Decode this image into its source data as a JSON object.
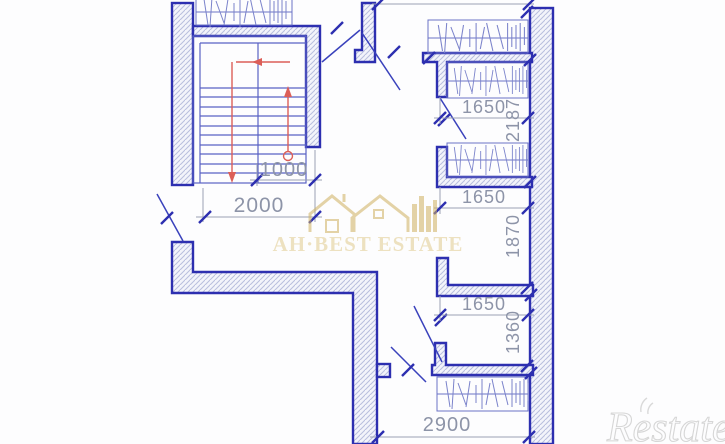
{
  "drawing": {
    "dimensions": {
      "top_room_width": "1650",
      "top_room_height": "2187",
      "mid_room_width": "1650",
      "mid_room_height": "1870",
      "low_room_width": "1650",
      "low_room_height": "1360",
      "bottom_room_width": "2900",
      "stair_flight_width": "1000",
      "stair_total_width": "2000"
    },
    "watermark": {
      "agency_name": "AH·BEST ESTATE"
    },
    "corner_logo": "Restate"
  }
}
